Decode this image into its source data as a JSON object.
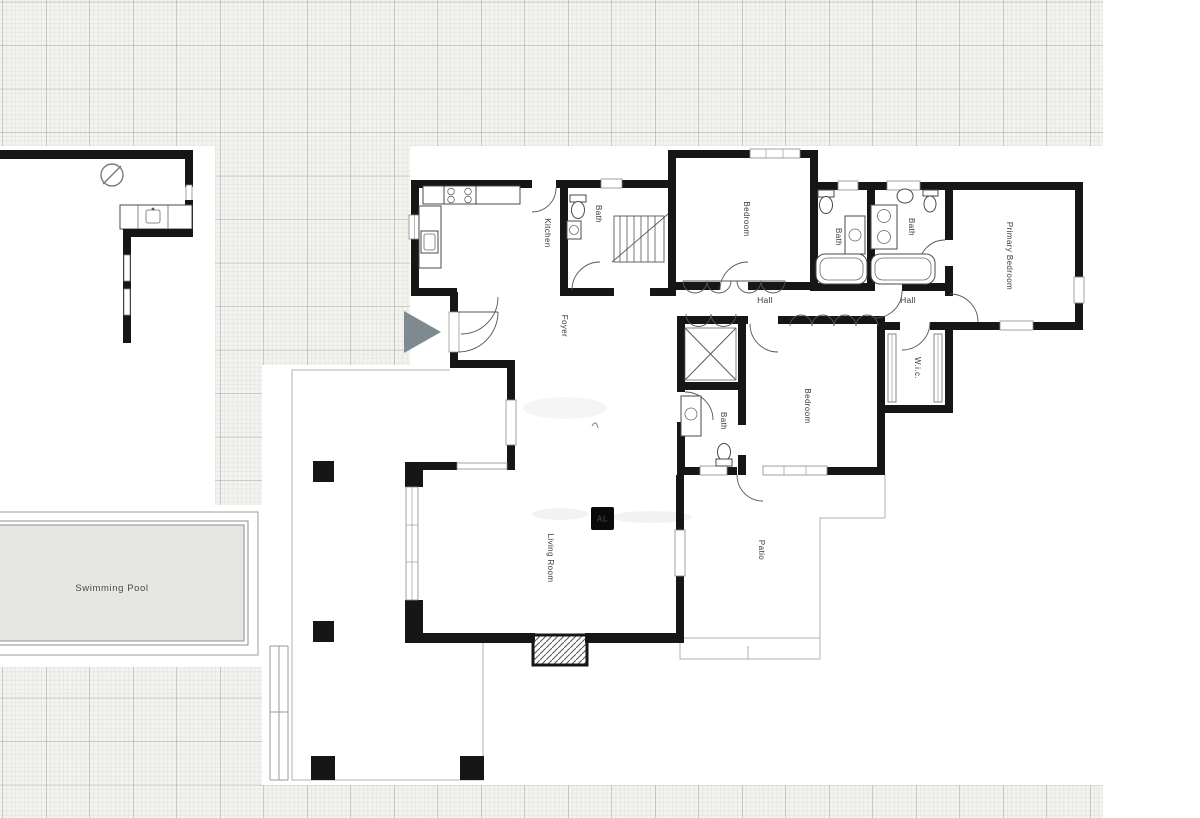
{
  "page": {
    "type": "architectural-floor-plan"
  },
  "rooms": {
    "kitchen": {
      "label": "Kitchen"
    },
    "bath_top": {
      "label": "Bath"
    },
    "bedroom_top": {
      "label": "Bedroom"
    },
    "bath_ensuite_left": {
      "label": "Bath"
    },
    "bath_ensuite_right": {
      "label": "Bath"
    },
    "primary_bedroom": {
      "label": "Primary Bedroom"
    },
    "hall_west": {
      "label": "Hall"
    },
    "hall_east": {
      "label": "Hall"
    },
    "foyer": {
      "label": "Foyer"
    },
    "wic": {
      "label": "W.i.c."
    },
    "bedroom_second": {
      "label": "Bedroom"
    },
    "bath_lower": {
      "label": "Bath"
    },
    "living_room": {
      "label": "Living Room"
    },
    "patio": {
      "label": "Patio"
    },
    "swimming_pool": {
      "label": "Swimming Pool"
    }
  },
  "watermark": {
    "logo_text": "AL"
  },
  "colors": {
    "wall": "#161616",
    "grid_bg": "#f3f3f0",
    "grid_major": "#a2a29f",
    "grid_minor": "#e2e2dd",
    "sheet": "#ffffff",
    "pool_fill": "#e6e6e3",
    "pool_border": "#999999",
    "marker": "#7e8a90",
    "logo_bg": "#0a0a0a",
    "logo_text_color": "#ffffff",
    "label_color": "#3a3a3a"
  }
}
